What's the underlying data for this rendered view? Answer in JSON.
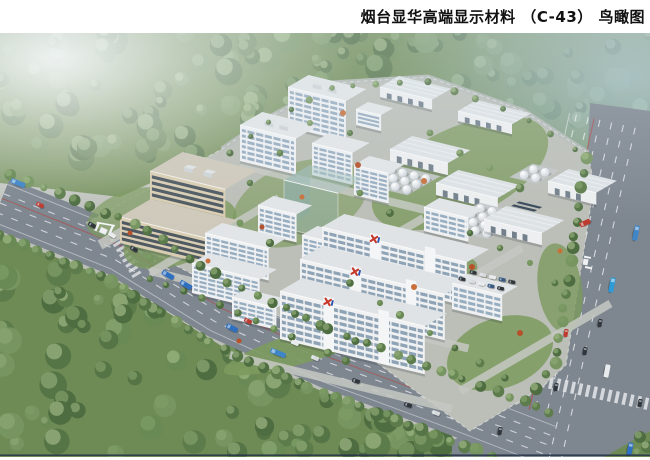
{
  "header": {
    "title": "烟台显华高端显示材料 （C-43） 鸟瞰图"
  },
  "logo": {
    "mark": "X",
    "red": "#c8382a",
    "blue": "#2a4fae"
  },
  "colors": {
    "page_bg": "#ffffff",
    "ground": "#bcbfb8",
    "grass": "#7c9a5e",
    "forest_base": "#6f8b55",
    "forest_dark": "#4e6d41",
    "forest_mid": "#6a8a55",
    "forest_light": "#86a06b",
    "road": "#7e8690",
    "road_dark": "#6e7680",
    "campus_road": "#c6c9c3",
    "wall_white": "#eff1f3",
    "wall_shade": "#d6dbdf",
    "roof": "#e2e5e7",
    "window": "#8ba3b8",
    "window_dark": "#7f97ac",
    "tan_wall": "#d9ceb3",
    "tan_shade": "#c3b89d",
    "tan_window": "#47525e",
    "tan_roof": "#cfc9bb",
    "warehouse_roof": "#dde2e5",
    "door_dark": "#5d6c7a",
    "tank_rim": "#b6bdc3",
    "ghost_wall": "rgba(151,181,177,0.42)",
    "ghost_side": "rgba(130,162,158,0.45)",
    "ghost_roof": "rgba(168,196,191,0.50)",
    "haze_blue": "#a8c2d2",
    "marking": "#f2f4f6",
    "red_line": "#c0392b",
    "border_line": "#253349"
  },
  "vehicles": {
    "bus_blue": "#3f86c9",
    "truck_blue": "#2e6fc0",
    "car_red": "#bf3a2e",
    "car_dark": "#31363d",
    "car_white": "#e9ebed",
    "car_grey": "#d8dbde"
  }
}
